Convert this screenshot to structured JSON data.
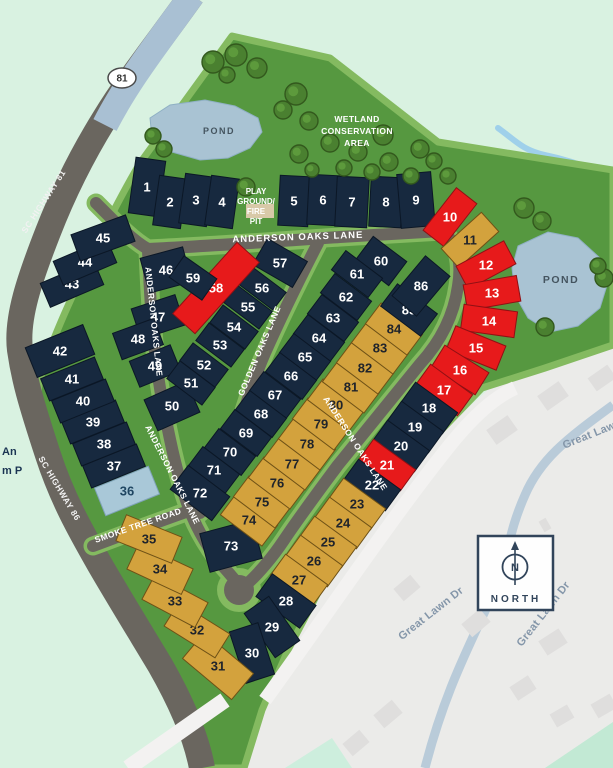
{
  "map_title": "Anderson Oaks site plan",
  "labels": {
    "roads": {
      "anderson_top": "ANDERSON OAKS LANE",
      "anderson_left_upper": "ANDERSON OAKS LANE",
      "anderson_left_lower": "ANDERSON OAKS LANE",
      "anderson_right": "ANDERSON OAKS LANE",
      "golden": "GOLDEN OAKS LANE",
      "smoke": "SMOKE TREE ROAD",
      "sc81": "SC HIGHWAY 81",
      "sc86": "SC HIGHWAY 86",
      "shield": "81",
      "great_lawn_1": "Great Lawn Dr",
      "great_lawn_2": "Great Lawn Dr",
      "great_lawn_3": "Great Lawn Dr"
    },
    "features": {
      "pond_left": "POND",
      "pond_right": "POND",
      "wetland_1": "WETLAND",
      "wetland_2": "CONSERVATION",
      "wetland_3": "AREA",
      "play_1": "PLAY",
      "play_2": "GROUND/",
      "play_3": "FIRE",
      "play_4": "PIT",
      "north": "NORTH",
      "north_letter": "N",
      "edge_fragment_1": "An",
      "edge_fragment_2": "m P"
    }
  },
  "colors": {
    "navy": {
      "fill": "#17293f",
      "stroke": "#0b1726",
      "text": "#ffffff"
    },
    "red": {
      "fill": "#e71a1b",
      "stroke": "#901014",
      "text": "#ffffff"
    },
    "gold": {
      "fill": "#d3a23d",
      "stroke": "#6e5116",
      "text": "#20242b"
    },
    "blue": {
      "fill": "#a9c8d8",
      "stroke": "#7fa3b8",
      "text": "#1f4662"
    },
    "site_green": "#569840",
    "edge_green": "#84ba60",
    "mint": "#d9f2e1",
    "road_gray": "#6a665f",
    "highway_blue": "#a9c0d3",
    "faded_bg": "#ebebe9",
    "pond": "#a9c3d3"
  },
  "lots": [
    [
      1,
      147,
      187,
      30,
      56,
      8,
      "navy"
    ],
    [
      2,
      170,
      202,
      28,
      50,
      8,
      "navy"
    ],
    [
      3,
      196,
      200,
      28,
      50,
      8,
      "navy"
    ],
    [
      4,
      222,
      202,
      28,
      50,
      8,
      "navy"
    ],
    [
      5,
      294,
      201,
      30,
      50,
      3,
      "navy"
    ],
    [
      6,
      323,
      200,
      30,
      50,
      3,
      "navy"
    ],
    [
      7,
      352,
      202,
      32,
      50,
      3,
      "navy"
    ],
    [
      8,
      386,
      202,
      32,
      50,
      3,
      "navy"
    ],
    [
      9,
      416,
      200,
      34,
      54,
      -5,
      "navy"
    ],
    [
      10,
      450,
      217,
      54,
      26,
      -52,
      "red"
    ],
    [
      11,
      470,
      240,
      54,
      26,
      -42,
      "gold"
    ],
    [
      12,
      486,
      265,
      54,
      26,
      -28,
      "red"
    ],
    [
      13,
      492,
      293,
      54,
      26,
      -10,
      "red"
    ],
    [
      14,
      489,
      321,
      54,
      26,
      8,
      "red"
    ],
    [
      15,
      476,
      348,
      54,
      26,
      22,
      "red"
    ],
    [
      16,
      460,
      370,
      52,
      26,
      32,
      "red"
    ],
    [
      17,
      444,
      390,
      52,
      26,
      36,
      "red"
    ],
    [
      18,
      429,
      408,
      52,
      26,
      36,
      "navy"
    ],
    [
      19,
      415,
      427,
      52,
      26,
      36,
      "navy"
    ],
    [
      20,
      401,
      446,
      52,
      26,
      36,
      "navy"
    ],
    [
      21,
      387,
      465,
      52,
      26,
      36,
      "red"
    ],
    [
      22,
      372,
      485,
      52,
      26,
      36,
      "navy"
    ],
    [
      23,
      357,
      504,
      52,
      26,
      36,
      "gold"
    ],
    [
      24,
      343,
      523,
      52,
      26,
      36,
      "gold"
    ],
    [
      25,
      328,
      542,
      52,
      26,
      36,
      "gold"
    ],
    [
      26,
      314,
      561,
      52,
      26,
      36,
      "gold"
    ],
    [
      27,
      299,
      580,
      52,
      26,
      36,
      "gold"
    ],
    [
      28,
      286,
      601,
      54,
      28,
      36,
      "navy"
    ],
    [
      29,
      272,
      627,
      54,
      30,
      55,
      "navy"
    ],
    [
      30,
      252,
      653,
      54,
      30,
      72,
      "navy"
    ],
    [
      31,
      218,
      666,
      64,
      34,
      40,
      "gold"
    ],
    [
      32,
      197,
      630,
      60,
      28,
      32,
      "gold"
    ],
    [
      33,
      175,
      601,
      60,
      28,
      28,
      "gold"
    ],
    [
      34,
      160,
      569,
      60,
      28,
      25,
      "gold"
    ],
    [
      35,
      149,
      539,
      60,
      28,
      22,
      "gold"
    ],
    [
      36,
      127,
      491,
      58,
      30,
      -22,
      "blue"
    ],
    [
      37,
      114,
      466,
      58,
      24,
      -22,
      "navy"
    ],
    [
      38,
      104,
      444,
      58,
      24,
      -22,
      "navy"
    ],
    [
      39,
      93,
      422,
      58,
      24,
      -22,
      "navy"
    ],
    [
      40,
      83,
      401,
      58,
      24,
      -22,
      "navy"
    ],
    [
      41,
      72,
      379,
      58,
      24,
      -22,
      "navy"
    ],
    [
      42,
      60,
      351,
      62,
      32,
      -22,
      "navy"
    ],
    [
      43,
      72,
      284,
      58,
      26,
      -23,
      "navy"
    ],
    [
      44,
      85,
      262,
      58,
      26,
      -23,
      "navy"
    ],
    [
      45,
      103,
      238,
      58,
      28,
      -20,
      "navy"
    ],
    [
      46,
      166,
      270,
      44,
      36,
      -15,
      "navy"
    ],
    [
      47,
      158,
      317,
      46,
      32,
      -18,
      "navy"
    ],
    [
      48,
      138,
      339,
      44,
      28,
      -20,
      "navy"
    ],
    [
      49,
      155,
      366,
      44,
      28,
      -22,
      "navy"
    ],
    [
      50,
      172,
      406,
      46,
      34,
      -24,
      "navy"
    ],
    [
      51,
      191,
      383,
      44,
      22,
      37,
      "navy"
    ],
    [
      52,
      204,
      365,
      44,
      22,
      37,
      "navy"
    ],
    [
      53,
      220,
      345,
      44,
      22,
      37,
      "navy"
    ],
    [
      54,
      234,
      327,
      44,
      22,
      37,
      "navy"
    ],
    [
      55,
      248,
      307,
      44,
      22,
      37,
      "navy"
    ],
    [
      56,
      262,
      288,
      44,
      22,
      37,
      "navy"
    ],
    [
      57,
      280,
      263,
      46,
      30,
      30,
      "navy"
    ],
    [
      58,
      216,
      288,
      96,
      30,
      -48,
      "red"
    ],
    [
      59,
      193,
      278,
      40,
      26,
      35,
      "navy"
    ],
    [
      60,
      381,
      261,
      42,
      30,
      37,
      "navy"
    ],
    [
      61,
      357,
      274,
      46,
      24,
      37,
      "navy"
    ],
    [
      62,
      346,
      297,
      46,
      24,
      37,
      "navy"
    ],
    [
      63,
      333,
      318,
      46,
      24,
      37,
      "navy"
    ],
    [
      64,
      319,
      338,
      46,
      24,
      37,
      "navy"
    ],
    [
      65,
      305,
      357,
      46,
      24,
      37,
      "navy"
    ],
    [
      66,
      291,
      376,
      46,
      24,
      37,
      "navy"
    ],
    [
      67,
      275,
      395,
      46,
      24,
      37,
      "navy"
    ],
    [
      68,
      261,
      414,
      46,
      24,
      37,
      "navy"
    ],
    [
      69,
      246,
      433,
      46,
      24,
      37,
      "navy"
    ],
    [
      70,
      230,
      452,
      46,
      24,
      37,
      "navy"
    ],
    [
      71,
      214,
      470,
      46,
      24,
      37,
      "navy"
    ],
    [
      72,
      200,
      493,
      52,
      30,
      37,
      "navy"
    ],
    [
      73,
      231,
      546,
      54,
      40,
      -15,
      "navy"
    ],
    [
      74,
      249,
      520,
      52,
      26,
      37,
      "gold"
    ],
    [
      75,
      262,
      502,
      52,
      26,
      37,
      "gold"
    ],
    [
      76,
      277,
      483,
      52,
      26,
      37,
      "gold"
    ],
    [
      77,
      292,
      464,
      52,
      26,
      37,
      "gold"
    ],
    [
      78,
      307,
      444,
      52,
      26,
      37,
      "gold"
    ],
    [
      79,
      321,
      424,
      52,
      26,
      37,
      "gold"
    ],
    [
      80,
      336,
      405,
      52,
      26,
      37,
      "gold"
    ],
    [
      81,
      351,
      387,
      52,
      26,
      37,
      "gold"
    ],
    [
      82,
      365,
      368,
      52,
      26,
      37,
      "gold"
    ],
    [
      83,
      380,
      348,
      52,
      26,
      37,
      "gold"
    ],
    [
      84,
      394,
      329,
      52,
      26,
      37,
      "gold"
    ],
    [
      85,
      409,
      310,
      50,
      28,
      37,
      "navy"
    ],
    [
      86,
      421,
      286,
      52,
      32,
      -50,
      "navy"
    ]
  ],
  "trees": [
    [
      213,
      62,
      11
    ],
    [
      236,
      55,
      11
    ],
    [
      257,
      68,
      10
    ],
    [
      227,
      75,
      8
    ],
    [
      296,
      94,
      11
    ],
    [
      283,
      110,
      9
    ],
    [
      309,
      121,
      9
    ],
    [
      330,
      143,
      9
    ],
    [
      383,
      135,
      10
    ],
    [
      420,
      149,
      9
    ],
    [
      434,
      161,
      8
    ],
    [
      299,
      154,
      9
    ],
    [
      358,
      152,
      9
    ],
    [
      389,
      162,
      9
    ],
    [
      344,
      168,
      8
    ],
    [
      372,
      172,
      8
    ],
    [
      312,
      170,
      7
    ],
    [
      411,
      176,
      8
    ],
    [
      448,
      176,
      8
    ],
    [
      153,
      136,
      8
    ],
    [
      164,
      149,
      8
    ],
    [
      246,
      187,
      9
    ],
    [
      524,
      208,
      10
    ],
    [
      542,
      221,
      9
    ],
    [
      604,
      278,
      9
    ],
    [
      598,
      266,
      8
    ],
    [
      545,
      327,
      9
    ]
  ],
  "houses": [
    [
      502,
      430,
      26,
      18,
      -35
    ],
    [
      553,
      396,
      26,
      18,
      -35
    ],
    [
      602,
      378,
      24,
      16,
      -35
    ],
    [
      407,
      588,
      22,
      16,
      -40
    ],
    [
      476,
      623,
      24,
      17,
      -40
    ],
    [
      553,
      642,
      24,
      17,
      -33
    ],
    [
      523,
      688,
      22,
      16,
      -33
    ],
    [
      562,
      716,
      20,
      15,
      -30
    ],
    [
      388,
      714,
      24,
      17,
      -40
    ],
    [
      356,
      743,
      22,
      16,
      -40
    ],
    [
      604,
      706,
      22,
      16,
      -30
    ],
    [
      545,
      525,
      8,
      12,
      -30
    ]
  ]
}
